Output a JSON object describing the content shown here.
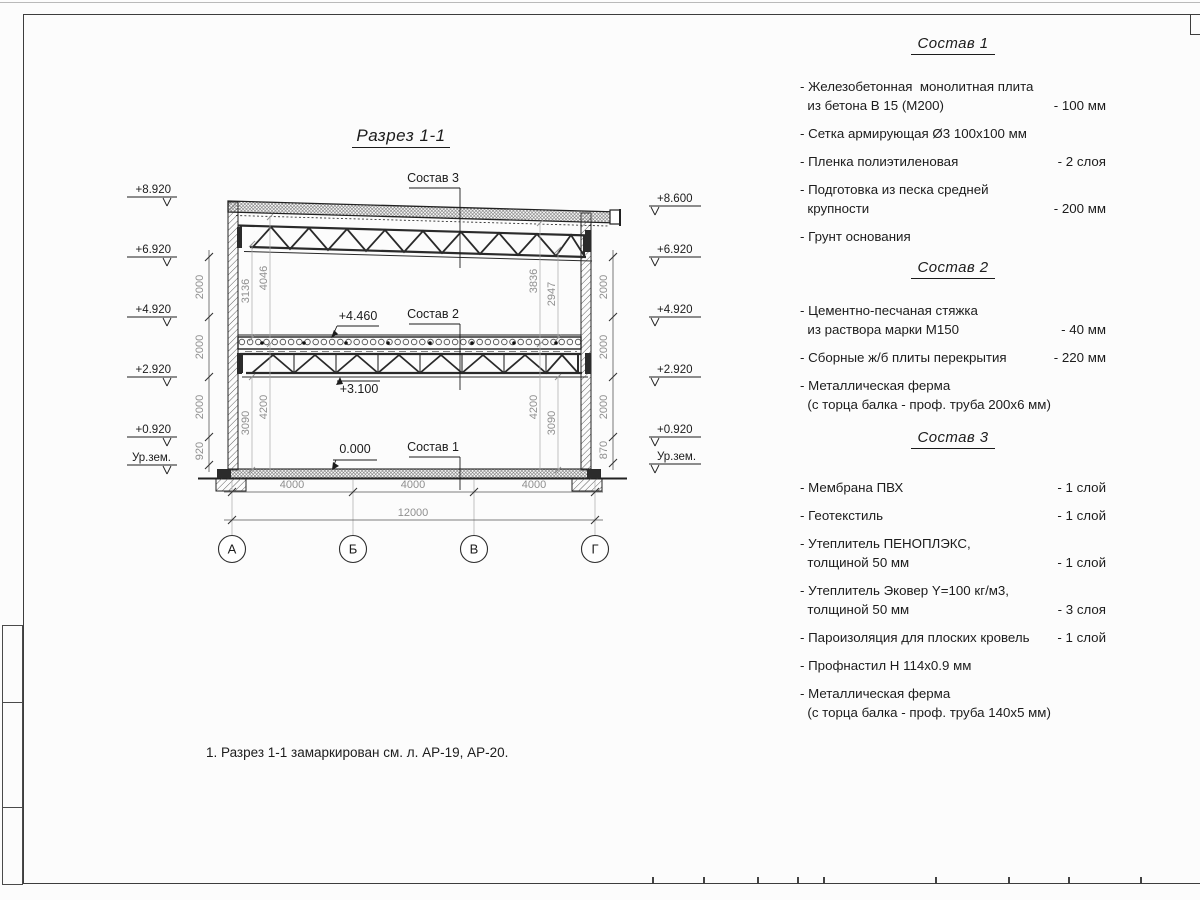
{
  "colors": {
    "line": "#222222",
    "dim_gray": "#8f8f8f",
    "text": "#1c1c1c"
  },
  "section": {
    "title": "Разрез 1-1",
    "callouts": {
      "c3": "Состав 3",
      "c2": "Состав 2",
      "c1": "Состав 1"
    },
    "marks": {
      "m4460": "+4.460",
      "m3100": "+3.100",
      "m0": "0.000"
    },
    "elev_left": [
      "+8.920",
      "+6.920",
      "+4.920",
      "+2.920",
      "+0.920",
      "Ур.зем."
    ],
    "elev_right": [
      "+8.600",
      "+6.920",
      "+4.920",
      "+2.920",
      "+0.920",
      "Ур.зем."
    ],
    "chain_left": [
      "2000",
      "2000",
      "2000",
      "920"
    ],
    "chain_right": [
      "2000",
      "2000",
      "2000",
      "870"
    ],
    "vdims": {
      "lt0": "3136",
      "lt1": "4046",
      "rt0": "3836",
      "rt1": "2947",
      "lb0": "3090",
      "lb1": "4200",
      "rb0": "4200",
      "rb1": "3090"
    },
    "hdims": {
      "s0": "4000",
      "s1": "4000",
      "s2": "4000",
      "total": "12000"
    },
    "axes": [
      "А",
      "Б",
      "В",
      "Г"
    ]
  },
  "specs": [
    {
      "title": "Состав 1",
      "items": [
        {
          "text": "- Железобетонная  монолитная плита\n  из бетона В 15 (М200)",
          "value": "- 100 мм"
        },
        {
          "text": "- Сетка армирующая Ø3 100х100 мм",
          "value": ""
        },
        {
          "text": "- Пленка полиэтиленовая",
          "value": "-  2 слоя"
        },
        {
          "text": "- Подготовка из песка средней\n  крупности",
          "value": "- 200 мм"
        },
        {
          "text": "- Грунт основания",
          "value": ""
        }
      ]
    },
    {
      "title": "Состав 2",
      "items": [
        {
          "text": "- Цементно-песчаная стяжка\n  из раствора марки М150",
          "value": "- 40 мм"
        },
        {
          "text": "- Сборные ж/б плиты перекрытия",
          "value": "- 220 мм"
        },
        {
          "text": "- Металлическая ферма\n  (с торца балка - проф. труба 200х6 мм)",
          "value": ""
        }
      ]
    },
    {
      "title": "Состав 3",
      "items": [
        {
          "text": "- Мембрана ПВХ",
          "value": "- 1 слой"
        },
        {
          "text": "- Геотекстиль",
          "value": "- 1 слой"
        },
        {
          "text": "- Утеплитель ПЕНОПЛЭКС,\n  толщиной 50 мм",
          "value": "- 1 слой"
        },
        {
          "text": "- Утеплитель Эковер Y=100 кг/м3,\n  толщиной 50 мм",
          "value": "- 3 слоя"
        },
        {
          "text": "- Пароизоляция для плоских кровель",
          "value": "- 1 слой"
        },
        {
          "text": "- Профнастил Н 114х0.9 мм",
          "value": ""
        },
        {
          "text": "- Металлическая ферма\n  (с торца балка - проф. труба 140х5 мм)",
          "value": ""
        }
      ]
    }
  ],
  "note": "1. Разрез 1-1 замаркирован см. л. АР-19, АР-20."
}
